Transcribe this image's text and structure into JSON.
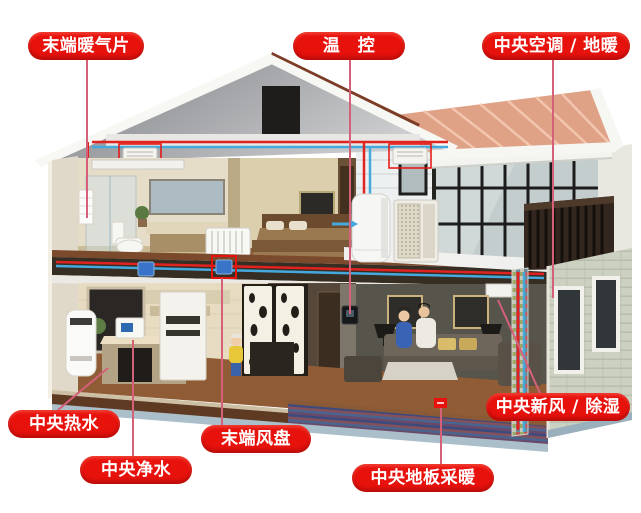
{
  "callouts": [
    {
      "id": "terminal-radiator",
      "text": "末端暖气片"
    },
    {
      "id": "thermostat",
      "text": "温　控"
    },
    {
      "id": "central-ac-floor-heating",
      "text": "中央空调 / 地暖"
    },
    {
      "id": "central-hot-water",
      "text": "中央热水"
    },
    {
      "id": "central-water-purification",
      "text": "中央净水"
    },
    {
      "id": "terminal-fan-coil",
      "text": "末端风盘"
    },
    {
      "id": "central-floor-heating",
      "text": "中央地板采暖"
    },
    {
      "id": "central-fresh-air-dehumidify",
      "text": "中央新风 / 除湿"
    }
  ],
  "colors": {
    "label_bg": "#e8120d",
    "label_text": "#ffffff",
    "connector_line": "#d4607a",
    "hot_pipe": "#e02321",
    "cold_pipe": "#45a9de",
    "roof_tiles": "#e0a287",
    "floor_coil_marker": "#e8120d"
  }
}
